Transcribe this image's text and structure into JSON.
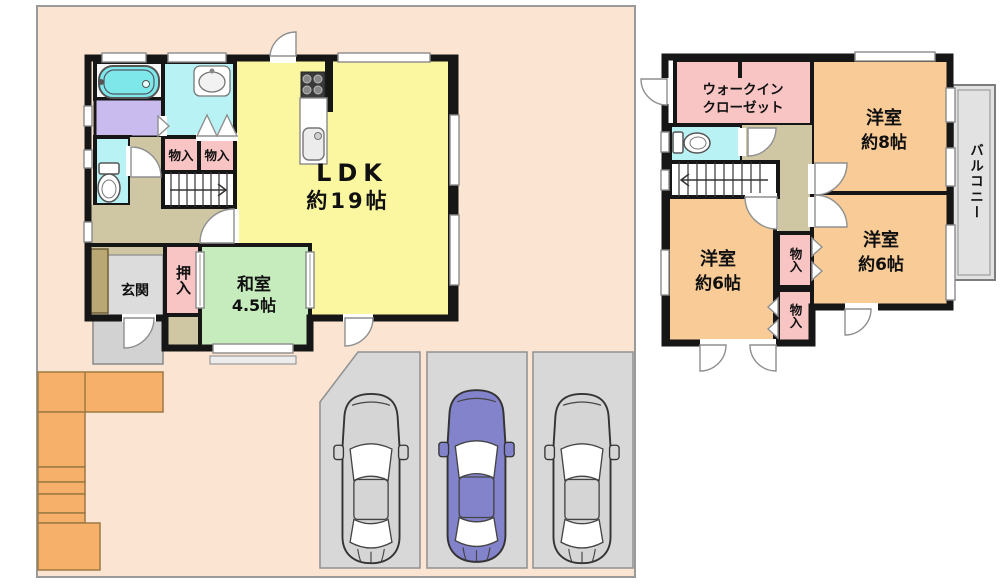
{
  "floor1": {
    "ldk_label": "LDK",
    "ldk_size": "約19帖",
    "washitsu_label": "和室",
    "washitsu_size": "4.5帖",
    "genkan_label": "玄関",
    "oshiire_label": "押入",
    "monoire_left_label": "物入",
    "monoire_right_label": "物入"
  },
  "floor2": {
    "wic_line1": "ウォークイン",
    "wic_line2": "クローゼット",
    "yoshitsu8_label": "洋室",
    "yoshitsu8_size": "約8帖",
    "yoshitsu6_left_label": "洋室",
    "yoshitsu6_left_size": "約6帖",
    "yoshitsu6_right_label": "洋室",
    "yoshitsu6_right_size": "約6帖",
    "monoire_upper_label": "物入",
    "monoire_lower_label": "物入",
    "balcony_label": "バルコニー"
  },
  "colors": {
    "site_bg": "#fbe5d2",
    "ldk": "#faf7a0",
    "tatami": "#c6ecbe",
    "western_room": "#f8cb97",
    "closet_pink": "#f9c4c4",
    "wet_area_cyan": "#b9f2f5",
    "laundry_purple": "#c9bbee",
    "hallway_tan": "#cfc6a4",
    "entrance_gray": "#dcdcdc",
    "shoe_cabinet_tan": "#b9a774",
    "porch_gray": "#d2d2d2",
    "parking_gray": "#d8d8d8",
    "exterior_stairs_orange": "#f6b06a",
    "balcony_gray": "#e2e2e2",
    "car_gray": "#d5d5d5",
    "car_purple": "#8383cb",
    "tub_cyan": "#7de7ea",
    "stove_dark": "#3a3a3a",
    "wall": "#161616"
  }
}
